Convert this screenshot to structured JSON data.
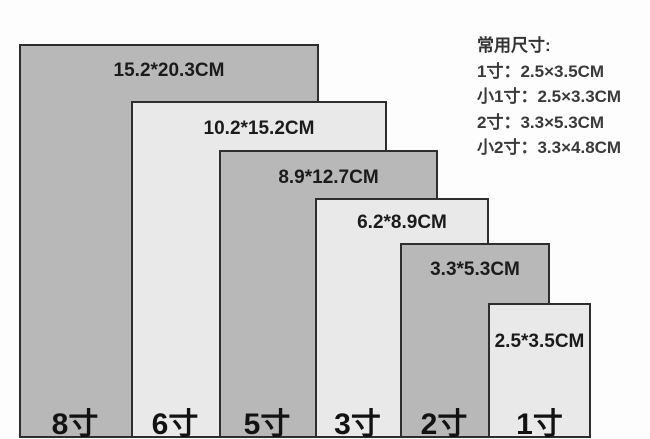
{
  "chart": {
    "sizes": [
      {
        "name": "8寸",
        "dimensions": "15.2*20.3CM",
        "tone": "dark"
      },
      {
        "name": "6寸",
        "dimensions": "10.2*15.2CM",
        "tone": "light"
      },
      {
        "name": "5寸",
        "dimensions": "8.9*12.7CM",
        "tone": "dark"
      },
      {
        "name": "3寸",
        "dimensions": "6.2*8.9CM",
        "tone": "light"
      },
      {
        "name": "2寸",
        "dimensions": "3.3*5.3CM",
        "tone": "dark"
      },
      {
        "name": "1寸",
        "dimensions": "2.5*3.5CM",
        "tone": "light"
      }
    ],
    "colors": {
      "dark_fill": "#b8b8b8",
      "light_fill": "#e9e9e9",
      "border": "#2e2e2e",
      "background": "#fdfdfd",
      "label_text": "#1b1b1b",
      "legend_text": "#3a3a3a"
    }
  },
  "legend": {
    "title": "常用尺寸:",
    "items": [
      "1寸：2.5×3.5CM",
      "小1寸：2.5×3.3CM",
      "2寸：3.3×5.3CM",
      "小2寸：3.3×4.8CM"
    ]
  }
}
